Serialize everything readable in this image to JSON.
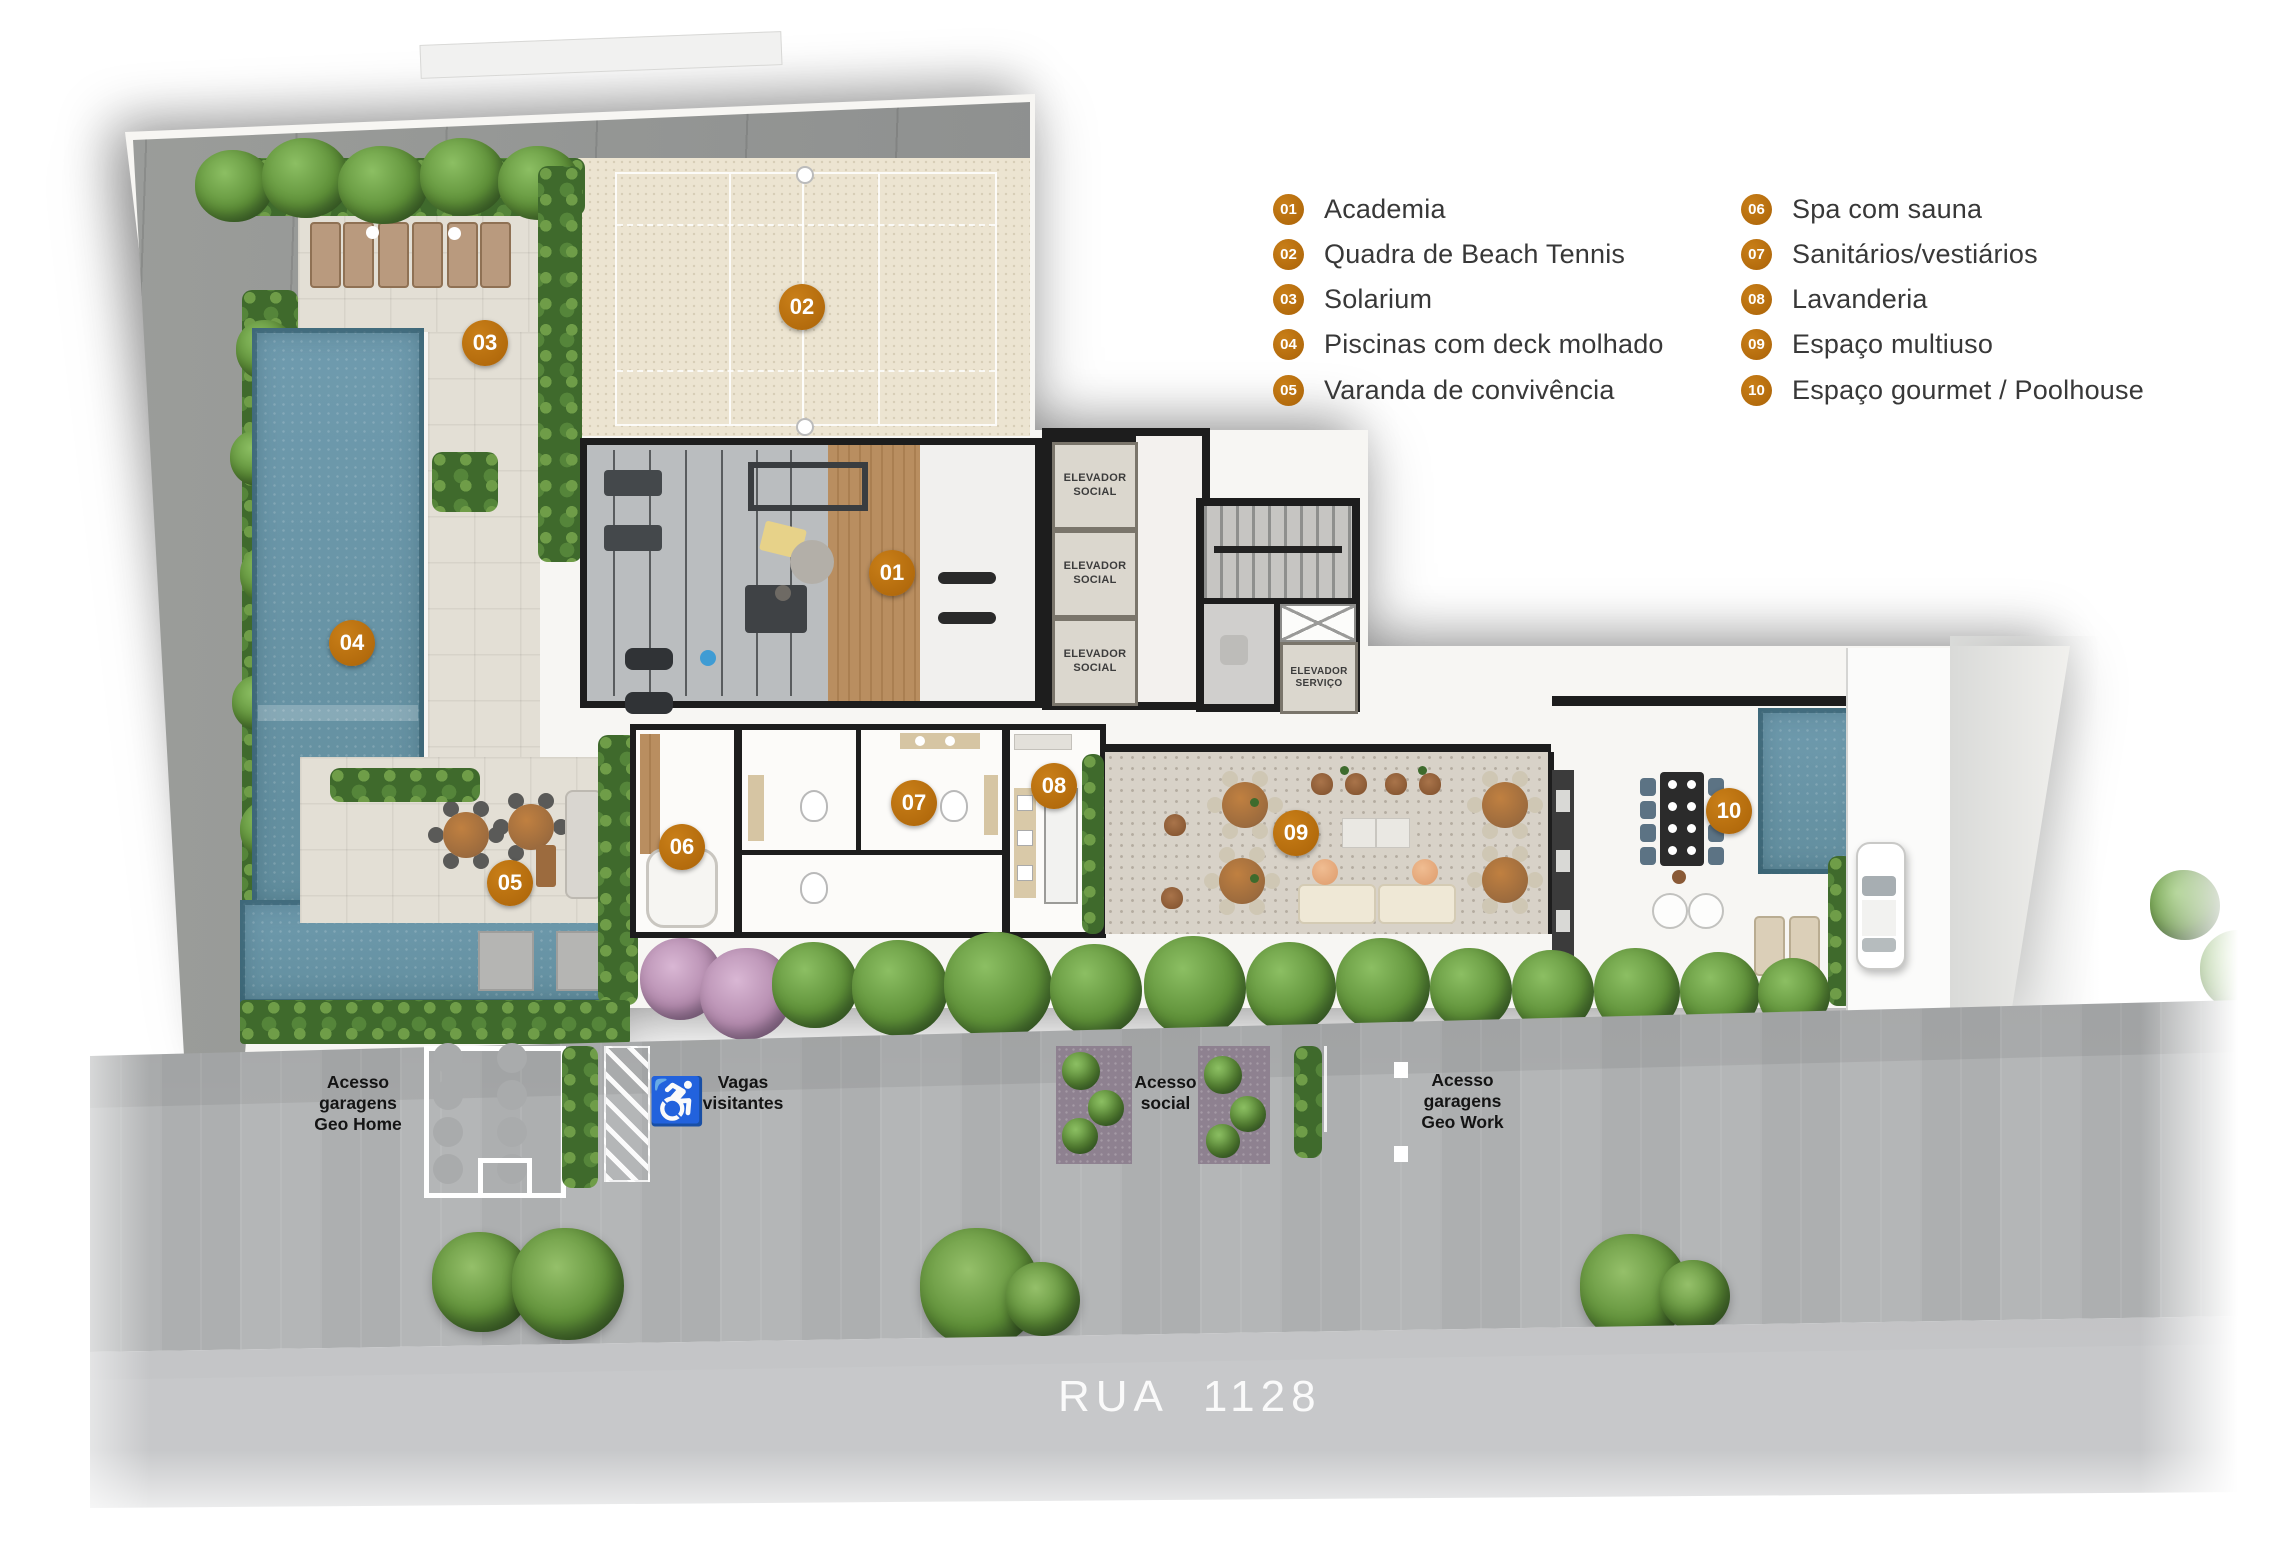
{
  "legend": {
    "items": [
      {
        "num": "01",
        "label": "Academia"
      },
      {
        "num": "02",
        "label": "Quadra de Beach Tennis"
      },
      {
        "num": "03",
        "label": "Solarium"
      },
      {
        "num": "04",
        "label": "Piscinas com deck molhado"
      },
      {
        "num": "05",
        "label": "Varanda de convivência"
      },
      {
        "num": "06",
        "label": "Spa com sauna"
      },
      {
        "num": "07",
        "label": "Sanitários/vestiários"
      },
      {
        "num": "08",
        "label": "Lavanderia"
      },
      {
        "num": "09",
        "label": "Espaço multiuso"
      },
      {
        "num": "10",
        "label": "Espaço gourmet / Poolhouse"
      }
    ]
  },
  "plan": {
    "markers": [
      {
        "num": "01",
        "x": 892,
        "y": 573
      },
      {
        "num": "02",
        "x": 802,
        "y": 307
      },
      {
        "num": "03",
        "x": 485,
        "y": 343
      },
      {
        "num": "04",
        "x": 352,
        "y": 643
      },
      {
        "num": "05",
        "x": 510,
        "y": 883
      },
      {
        "num": "06",
        "x": 682,
        "y": 847
      },
      {
        "num": "07",
        "x": 914,
        "y": 803
      },
      {
        "num": "08",
        "x": 1054,
        "y": 786
      },
      {
        "num": "09",
        "x": 1296,
        "y": 833
      },
      {
        "num": "10",
        "x": 1729,
        "y": 811
      }
    ],
    "elevators": [
      "ELEVADOR\nSOCIAL",
      "ELEVADOR\nSOCIAL",
      "ELEVADOR\nSOCIAL"
    ],
    "elevator_servico": "ELEVADOR\nSERVIÇO"
  },
  "site": {
    "access_home": "Acesso\ngaragens\nGeo Home",
    "vagas": "Vagas\nvisitantes",
    "access_social": "Acesso\nsocial",
    "access_work": "Acesso\ngaragens\nGeo Work"
  },
  "road": {
    "name": "RUA  1128"
  },
  "icons": {
    "wheelchair": "♿"
  },
  "colors": {
    "badge_orange": "#b96f10",
    "sand": "#ece4d1",
    "water": "#6e9aad",
    "hedge_green": "#4e7a33",
    "road_text": "#ffffff"
  }
}
